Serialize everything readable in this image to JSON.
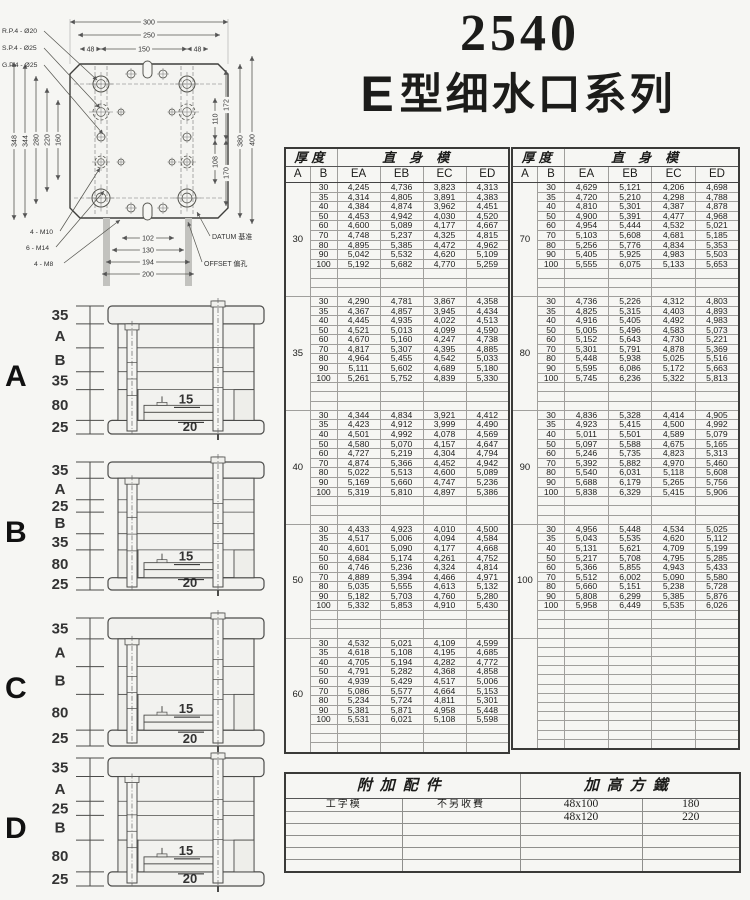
{
  "header": {
    "model": "2540",
    "series_prefix": "E",
    "series_text": "型细水口系列"
  },
  "drawing": {
    "hole_callouts": [
      "R.P.4 - Ø20",
      "S.P.4 - Ø25",
      "G.P.4 - Ø25"
    ],
    "thread_callouts": [
      "4 - M10",
      "6 - M14",
      "4 - M8"
    ],
    "datum_label": "DATUM 基准",
    "offset_label": "OFFSET 偏孔",
    "dims_top": [
      "300",
      "250",
      "48",
      "150",
      "48"
    ],
    "dims_left": [
      "348",
      "344",
      "280",
      "220",
      "160"
    ],
    "dims_right_inner": [
      "172",
      "110",
      "108",
      "170"
    ],
    "dims_right_outer": [
      "380",
      "400"
    ],
    "dims_bottom": [
      "102",
      "130",
      "194",
      "200"
    ]
  },
  "tables": {
    "header": {
      "thickness_label": "厚度",
      "body_label": "直身模",
      "col_a": "A",
      "col_b": "B",
      "price_cols": [
        "EA",
        "EB",
        "EC",
        "ED"
      ]
    },
    "left_blocks": [
      {
        "a": "30",
        "rows": [
          [
            "30",
            "4,245",
            "4,736",
            "3,823",
            "4,313"
          ],
          [
            "35",
            "4,314",
            "4,805",
            "3,891",
            "4,383"
          ],
          [
            "40",
            "4,384",
            "4,874",
            "3,962",
            "4,451"
          ],
          [
            "50",
            "4,453",
            "4,942",
            "4,030",
            "4,520"
          ],
          [
            "60",
            "4,600",
            "5,089",
            "4,177",
            "4,667"
          ],
          [
            "70",
            "4,748",
            "5,237",
            "4,325",
            "4,815"
          ],
          [
            "80",
            "4,895",
            "5,385",
            "4,472",
            "4,962"
          ],
          [
            "90",
            "5,042",
            "5,532",
            "4,620",
            "5,109"
          ],
          [
            "100",
            "5,192",
            "5,682",
            "4,770",
            "5,259"
          ]
        ]
      },
      {
        "a": "35",
        "rows": [
          [
            "30",
            "4,290",
            "4,781",
            "3,867",
            "4,358"
          ],
          [
            "35",
            "4,367",
            "4,857",
            "3,945",
            "4,434"
          ],
          [
            "40",
            "4,445",
            "4,935",
            "4,022",
            "4,513"
          ],
          [
            "50",
            "4,521",
            "5,013",
            "4,099",
            "4,590"
          ],
          [
            "60",
            "4,670",
            "5,160",
            "4,247",
            "4,738"
          ],
          [
            "70",
            "4,817",
            "5,307",
            "4,395",
            "4,885"
          ],
          [
            "80",
            "4,964",
            "5,455",
            "4,542",
            "5,033"
          ],
          [
            "90",
            "5,111",
            "5,602",
            "4,689",
            "5,180"
          ],
          [
            "100",
            "5,261",
            "5,752",
            "4,839",
            "5,330"
          ]
        ]
      },
      {
        "a": "40",
        "rows": [
          [
            "30",
            "4,344",
            "4,834",
            "3,921",
            "4,412"
          ],
          [
            "35",
            "4,423",
            "4,912",
            "3,999",
            "4,490"
          ],
          [
            "40",
            "4,501",
            "4,992",
            "4,078",
            "4,569"
          ],
          [
            "50",
            "4,580",
            "5,070",
            "4,157",
            "4,647"
          ],
          [
            "60",
            "4,727",
            "5,219",
            "4,304",
            "4,794"
          ],
          [
            "70",
            "4,874",
            "5,366",
            "4,452",
            "4,942"
          ],
          [
            "80",
            "5,022",
            "5,513",
            "4,600",
            "5,089"
          ],
          [
            "90",
            "5,169",
            "5,660",
            "4,747",
            "5,236"
          ],
          [
            "100",
            "5,319",
            "5,810",
            "4,897",
            "5,386"
          ]
        ]
      },
      {
        "a": "50",
        "rows": [
          [
            "30",
            "4,433",
            "4,923",
            "4,010",
            "4,500"
          ],
          [
            "35",
            "4,517",
            "5,006",
            "4,094",
            "4,584"
          ],
          [
            "40",
            "4,601",
            "5,090",
            "4,177",
            "4,668"
          ],
          [
            "50",
            "4,684",
            "5,174",
            "4,261",
            "4,752"
          ],
          [
            "60",
            "4,746",
            "5,236",
            "4,324",
            "4,814"
          ],
          [
            "70",
            "4,889",
            "5,394",
            "4,466",
            "4,971"
          ],
          [
            "80",
            "5,035",
            "5,555",
            "4,613",
            "5,132"
          ],
          [
            "90",
            "5,182",
            "5,703",
            "4,760",
            "5,280"
          ],
          [
            "100",
            "5,332",
            "5,853",
            "4,910",
            "5,430"
          ]
        ]
      },
      {
        "a": "60",
        "rows": [
          [
            "30",
            "4,532",
            "5,021",
            "4,109",
            "4,599"
          ],
          [
            "35",
            "4,618",
            "5,108",
            "4,195",
            "4,685"
          ],
          [
            "40",
            "4,705",
            "5,194",
            "4,282",
            "4,772"
          ],
          [
            "50",
            "4,791",
            "5,282",
            "4,368",
            "4,858"
          ],
          [
            "60",
            "4,939",
            "5,429",
            "4,517",
            "5,006"
          ],
          [
            "70",
            "5,086",
            "5,577",
            "4,664",
            "5,153"
          ],
          [
            "80",
            "5,234",
            "5,724",
            "4,811",
            "5,301"
          ],
          [
            "90",
            "5,381",
            "5,871",
            "4,958",
            "5,448"
          ],
          [
            "100",
            "5,531",
            "6,021",
            "5,108",
            "5,598"
          ]
        ]
      }
    ],
    "right_blocks": [
      {
        "a": "70",
        "rows": [
          [
            "30",
            "4,629",
            "5,121",
            "4,206",
            "4,698"
          ],
          [
            "35",
            "4,720",
            "5,210",
            "4,298",
            "4,788"
          ],
          [
            "40",
            "4,810",
            "5,301",
            "4,387",
            "4,878"
          ],
          [
            "50",
            "4,900",
            "5,391",
            "4,477",
            "4,968"
          ],
          [
            "60",
            "4,954",
            "5,444",
            "4,532",
            "5,021"
          ],
          [
            "70",
            "5,103",
            "5,608",
            "4,681",
            "5,185"
          ],
          [
            "80",
            "5,256",
            "5,776",
            "4,834",
            "5,353"
          ],
          [
            "90",
            "5,405",
            "5,925",
            "4,983",
            "5,503"
          ],
          [
            "100",
            "5,555",
            "6,075",
            "5,133",
            "5,653"
          ]
        ]
      },
      {
        "a": "80",
        "rows": [
          [
            "30",
            "4,736",
            "5,226",
            "4,312",
            "4,803"
          ],
          [
            "35",
            "4,825",
            "5,315",
            "4,403",
            "4,893"
          ],
          [
            "40",
            "4,916",
            "5,405",
            "4,492",
            "4,983"
          ],
          [
            "50",
            "5,005",
            "5,496",
            "4,583",
            "5,073"
          ],
          [
            "60",
            "5,152",
            "5,643",
            "4,730",
            "5,221"
          ],
          [
            "70",
            "5,301",
            "5,791",
            "4,878",
            "5,369"
          ],
          [
            "80",
            "5,448",
            "5,938",
            "5,025",
            "5,516"
          ],
          [
            "90",
            "5,595",
            "6,086",
            "5,172",
            "5,663"
          ],
          [
            "100",
            "5,745",
            "6,236",
            "5,322",
            "5,813"
          ]
        ]
      },
      {
        "a": "90",
        "rows": [
          [
            "30",
            "4,836",
            "5,328",
            "4,414",
            "4,905"
          ],
          [
            "35",
            "4,923",
            "5,415",
            "4,500",
            "4,992"
          ],
          [
            "40",
            "5,011",
            "5,501",
            "4,589",
            "5,079"
          ],
          [
            "50",
            "5,097",
            "5,588",
            "4,675",
            "5,165"
          ],
          [
            "60",
            "5,246",
            "5,735",
            "4,823",
            "5,313"
          ],
          [
            "70",
            "5,392",
            "5,882",
            "4,970",
            "5,460"
          ],
          [
            "80",
            "5,540",
            "6,031",
            "5,118",
            "5,608"
          ],
          [
            "90",
            "5,688",
            "6,179",
            "5,265",
            "5,756"
          ],
          [
            "100",
            "5,838",
            "6,329",
            "5,415",
            "5,906"
          ]
        ]
      },
      {
        "a": "100",
        "rows": [
          [
            "30",
            "4,956",
            "5,448",
            "4,534",
            "5,025"
          ],
          [
            "35",
            "5,043",
            "5,535",
            "4,620",
            "5,112"
          ],
          [
            "40",
            "5,131",
            "5,621",
            "4,709",
            "5,199"
          ],
          [
            "50",
            "5,217",
            "5,708",
            "4,795",
            "5,285"
          ],
          [
            "60",
            "5,366",
            "5,855",
            "4,943",
            "5,433"
          ],
          [
            "70",
            "5,512",
            "6,002",
            "5,090",
            "5,580"
          ],
          [
            "80",
            "5,660",
            "5,151",
            "5,238",
            "5,728"
          ],
          [
            "90",
            "5,808",
            "6,299",
            "5,385",
            "5,876"
          ],
          [
            "100",
            "5,958",
            "6,449",
            "5,535",
            "6,026"
          ]
        ]
      }
    ]
  },
  "diagrams": [
    {
      "letter": "A",
      "dim_labels": [
        "35",
        "A",
        "B",
        "35",
        "80",
        "25"
      ],
      "inner_labels": [
        "15",
        "20"
      ]
    },
    {
      "letter": "B",
      "dim_labels": [
        "35",
        "A",
        "25",
        "B",
        "35",
        "80",
        "25"
      ],
      "inner_labels": [
        "15",
        "20"
      ]
    },
    {
      "letter": "C",
      "dim_labels": [
        "35",
        "A",
        "B",
        "80",
        "25"
      ],
      "inner_labels": [
        "15",
        "20"
      ]
    },
    {
      "letter": "D",
      "dim_labels": [
        "35",
        "A",
        "25",
        "B",
        "80",
        "25"
      ],
      "inner_labels": [
        "15",
        "20"
      ]
    }
  ],
  "accessory": {
    "header_left": "附加配件",
    "header_right": "加高方鐵",
    "rows": [
      [
        "工字模",
        "不另收費",
        "48x100",
        "180"
      ],
      [
        "",
        "",
        "48x120",
        "220"
      ],
      [
        "",
        "",
        "",
        ""
      ],
      [
        "",
        "",
        "",
        ""
      ],
      [
        "",
        "",
        "",
        ""
      ],
      [
        "",
        "",
        "",
        ""
      ]
    ]
  }
}
